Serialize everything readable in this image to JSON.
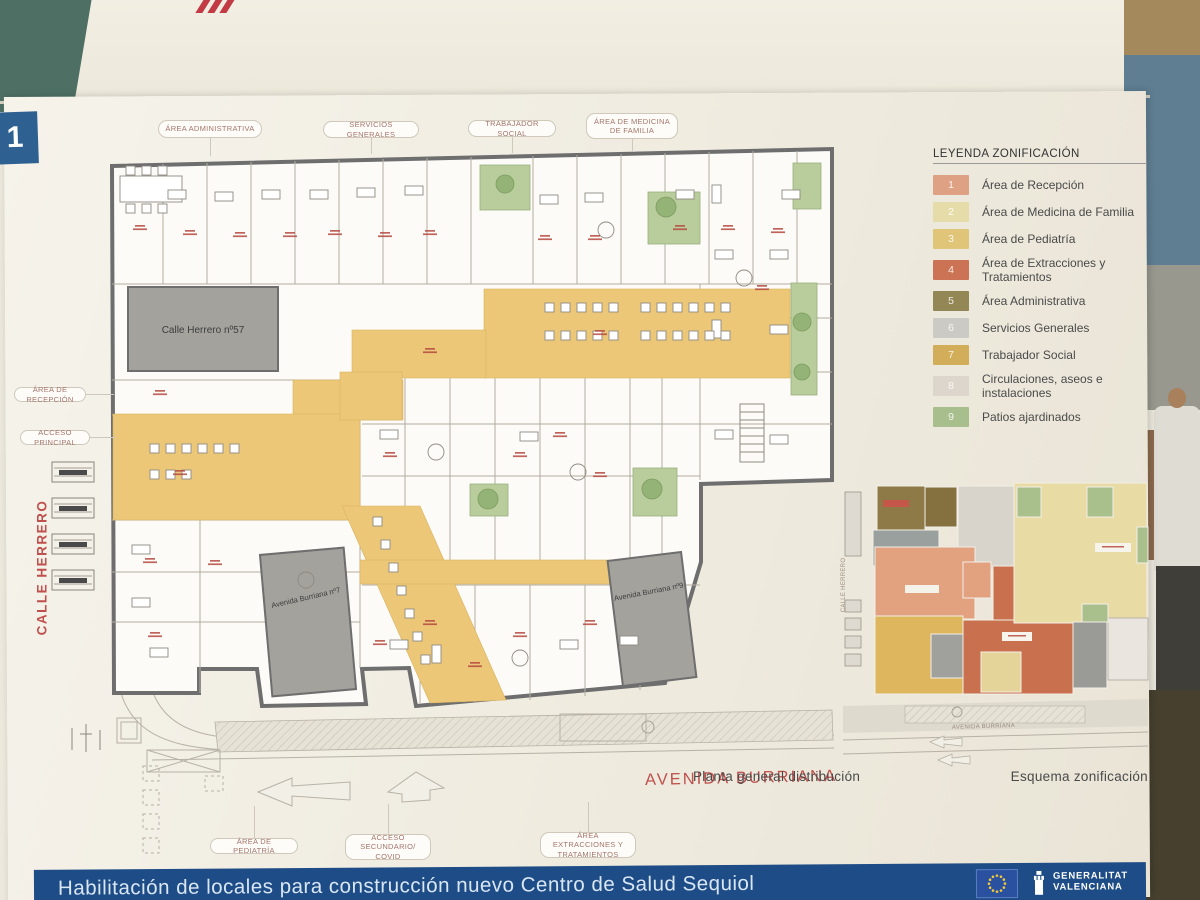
{
  "environment": {
    "badge_number": "1"
  },
  "poster": {
    "plan": {
      "pills_top": [
        {
          "label": "ÁREA ADMINISTRATIVA"
        },
        {
          "label": "SERVICIOS GENERALES"
        },
        {
          "label": "TRABAJADOR SOCIAL"
        },
        {
          "label": "ÁREA DE MEDICINA DE FAMILIA"
        }
      ],
      "pills_left": [
        {
          "label": "ÁREA DE RECEPCIÓN"
        },
        {
          "label": "ACCESO PRINCIPAL"
        }
      ],
      "pills_bottom": [
        {
          "label": "ÁREA DE PEDIATRÍA"
        },
        {
          "label": "ACCESO SECUNDARIO/ COVID"
        },
        {
          "label": "ÁREA EXTRACCIONES Y TRATAMIENTOS"
        }
      ],
      "street_left": "CALLE HERRERO",
      "street_bottom": "AVENIDA BURRIANA",
      "blocks": {
        "herrero_57": "Calle Herrero  nº57",
        "burriana_7": "Avenida Burriana nº7",
        "burriana_9": "Avenida Burriana nº9"
      },
      "caption": "Planta general distribución"
    },
    "legend": {
      "title": "LEYENDA ZONIFICACIÓN",
      "items": [
        {
          "num": "1",
          "label": "Área de Recepción",
          "color": "#dfa184"
        },
        {
          "num": "2",
          "label": "Área de Medicina de Familia",
          "color": "#e6dcaa"
        },
        {
          "num": "3",
          "label": "Área de Pediatría",
          "color": "#e0c478"
        },
        {
          "num": "4",
          "label": "Área de Extracciones y Tratamientos",
          "color": "#cb7354"
        },
        {
          "num": "5",
          "label": "Área Administrativa",
          "color": "#948756"
        },
        {
          "num": "6",
          "label": "Servicios Generales",
          "color": "#cbcac5"
        },
        {
          "num": "7",
          "label": "Trabajador Social",
          "color": "#d2ae5a"
        },
        {
          "num": "8",
          "label": "Circulaciones, aseos e instalaciones",
          "color": "#ddd6cd"
        },
        {
          "num": "9",
          "label": "Patios ajardinados",
          "color": "#a9be8d"
        }
      ]
    },
    "mini_map": {
      "caption": "Esquema zonificación",
      "street_left": "CALLE HERRERO",
      "street_bottom": "AVENIDA BURRIANA"
    },
    "footer": {
      "title": "Habilitación de locales para construcción nuevo Centro de Salud Sequiol",
      "org": {
        "line1": "GENERALITAT",
        "line2": "VALENCIANA"
      }
    }
  }
}
